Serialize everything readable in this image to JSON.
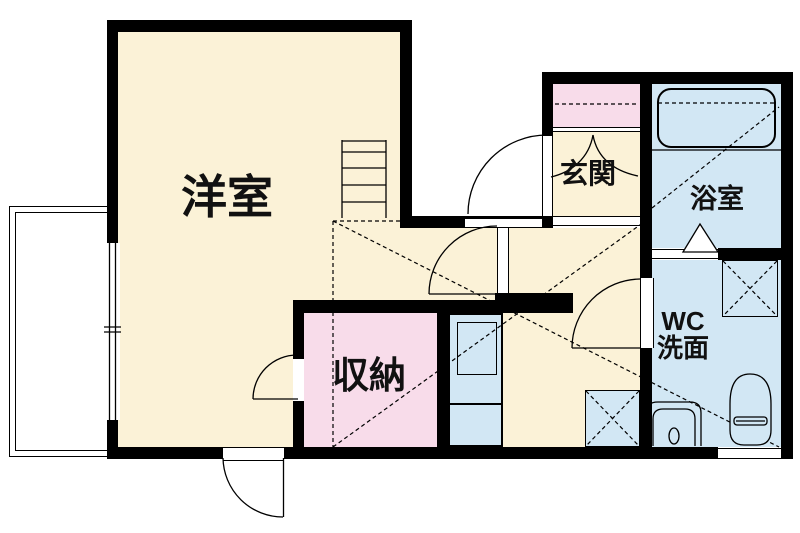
{
  "plan": {
    "type": "floor-plan",
    "rooms": {
      "western_room": {
        "label": "洋室"
      },
      "storage": {
        "label": "収納"
      },
      "entrance": {
        "label": "玄関"
      },
      "bathroom": {
        "label": "浴室"
      },
      "wc_washroom": {
        "label_line1": "WC",
        "label_line2": "洗面"
      }
    },
    "fixtures": [
      "bathtub",
      "toilet",
      "wash-basin",
      "kitchen-unit",
      "sink",
      "washing-machine-pan",
      "appliance-pan",
      "loft-ladder",
      "balcony"
    ],
    "colors": {
      "wall": "#000000",
      "floor_cream": "#FBF2D7",
      "floor_pink": "#F8DCEA",
      "floor_blue": "#D2E7F4",
      "exterior": "#FFFFFF",
      "label_text": "#111111"
    }
  }
}
